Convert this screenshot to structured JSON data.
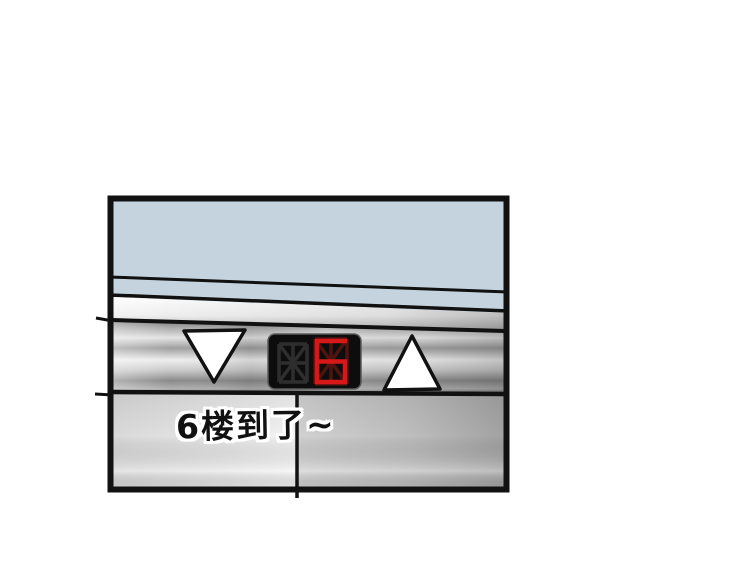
{
  "page": {
    "background": "#ffffff"
  },
  "panel": {
    "caption": "6楼到了~",
    "floor_display": {
      "left_digit": "off",
      "right_digit": "6",
      "value_shown": "6"
    },
    "buttons": [
      {
        "name": "down",
        "symbol": "▽"
      },
      {
        "name": "up",
        "symbol": "△"
      }
    ]
  },
  "colors": {
    "wall_blue": "#c4d3dd",
    "outline_black": "#111111",
    "display_bg": "#0d0d0d",
    "display_lit_red": "#d81818",
    "display_dim_red": "#4d1410",
    "display_off_segment": "#2e2e2e",
    "arrow_fill": "#ffffff",
    "caption_text": "#111111",
    "caption_outline": "#ffffff"
  }
}
